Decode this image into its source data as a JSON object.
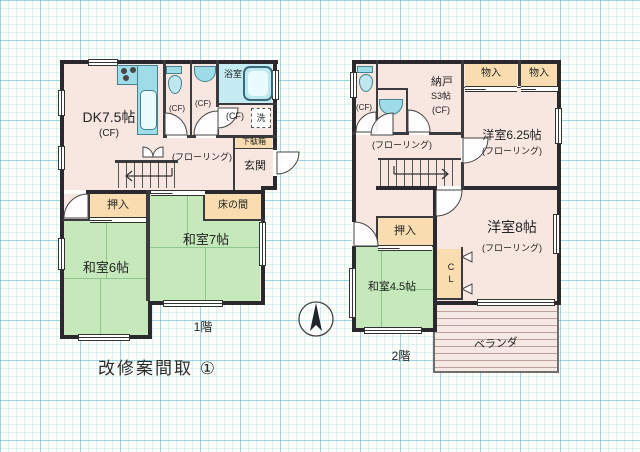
{
  "title": "改修案間取 ①",
  "compass": "north-arrow",
  "floor1": {
    "label": "1階",
    "dk": "DK7.5帖",
    "dk_cf": "(CF)",
    "toilet_cf": "(CF)",
    "vanity_cf": "(CF)",
    "bath": "浴室",
    "washroom_cf": "(CF)",
    "washer": "洗",
    "shoe_cabinet": "下駄箱",
    "entrance": "玄関",
    "hall_floor": "(フローリング)",
    "closet": "押入",
    "tokonoma": "床の間",
    "tatami7": "和室7帖",
    "tatami6": "和室6帖"
  },
  "floor2": {
    "label": "2階",
    "toilet_cf": "(CF)",
    "storeroom": "納戸",
    "storeroom_size": "S3帖",
    "storeroom_cf": "(CF)",
    "storage1": "物入",
    "storage2": "物入",
    "western625": "洋室6.25帖",
    "western625_floor": "(フローリング)",
    "hall_floor": "(フローリング)",
    "closet": "押入",
    "tatami45": "和室4.5帖",
    "cl": "CL",
    "western8": "洋室8帖",
    "western8_floor": "(フローリング)",
    "veranda": "ベランダ"
  },
  "colors": {
    "wall": "#2a2a2e",
    "room_pink": "#f8e7e1",
    "tatami_green": "#c6e9bc",
    "closet_beige": "#f9ddb0",
    "fixture_cyan": "#9edce8",
    "bath_cyan": "#c5ecf2",
    "grid_cyan": "#46b9cd"
  }
}
